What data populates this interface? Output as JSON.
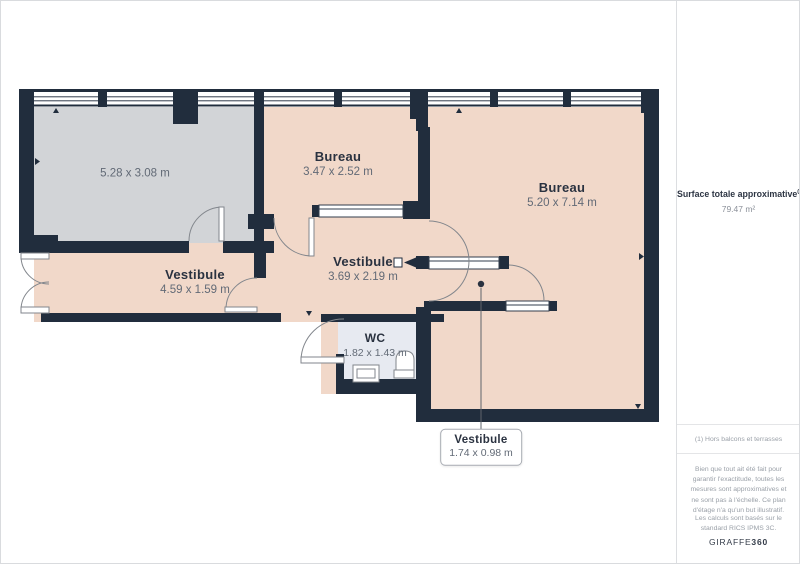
{
  "floorplan": {
    "rooms": {
      "balcony": {
        "dims": "5.28 x 3.08 m"
      },
      "bureau_small": {
        "name": "Bureau",
        "dims": "3.47 x 2.52 m"
      },
      "bureau_large": {
        "name": "Bureau",
        "dims": "5.20 x 7.14 m"
      },
      "vestibule_left": {
        "name": "Vestibule",
        "dims": "4.59 x 1.59 m"
      },
      "vestibule_middle": {
        "name": "Vestibule",
        "dims": "3.69 x 2.19 m"
      },
      "wc": {
        "name": "WC",
        "dims": "1.82 x 1.43 m"
      },
      "vestibule_small": {
        "name": "Vestibule",
        "dims": "1.74 x 0.98 m"
      }
    },
    "colors": {
      "wall": "#212d3d",
      "floor_main": "#f1d8c9",
      "floor_secondary": "#d2d4d7",
      "floor_wc": "#e7eaf1"
    }
  },
  "sidebar": {
    "surface_label": "Surface totale approximative",
    "surface_superscript": "(1)",
    "surface_value": "79.47 m²",
    "footnote": "(1) Hors balcons et terrasses",
    "disclaimer": "Bien que tout ait été fait pour garantir l'exactitude, toutes les mesures sont approximatives et ne sont pas à l'échelle. Ce plan d'étage n'a qu'un but illustratif.",
    "standard": "Les calculs sont basés sur le standard RICS IPMS 3C.",
    "brand_name": "GIRAFFE",
    "brand_suffix": "360"
  }
}
